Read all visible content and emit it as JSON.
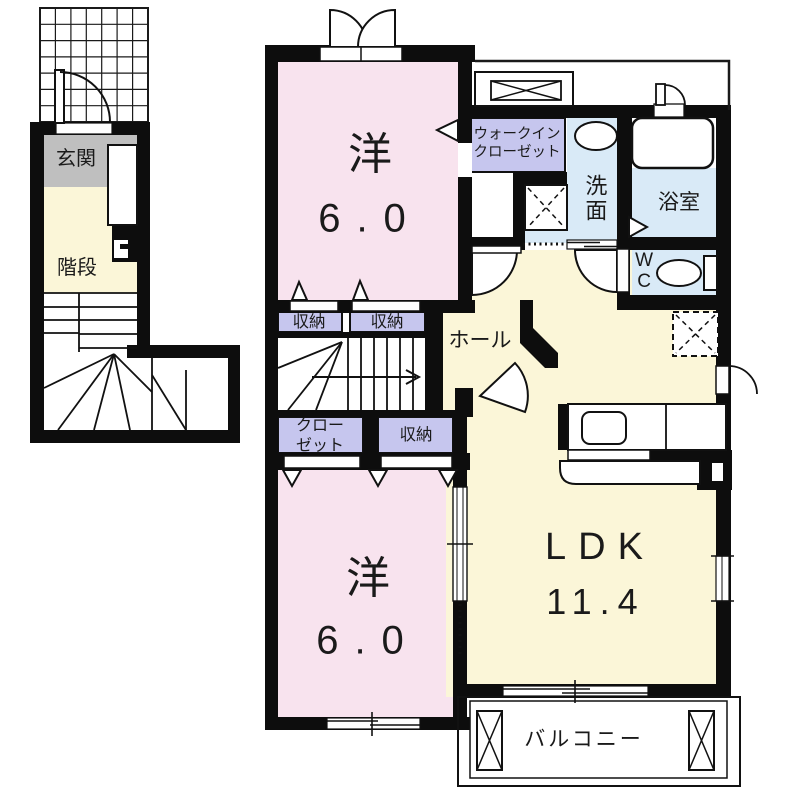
{
  "floorplan": {
    "entrance_label": "玄関",
    "stairs_label": "階段",
    "hall_label": "ホール",
    "bedroom_top": {
      "type": "洋",
      "size": "6.0"
    },
    "bedroom_bottom": {
      "type": "洋",
      "size": "6.0"
    },
    "ldk": {
      "type": "LDK",
      "size": "11.4"
    },
    "walk_in_closet_label": "ウォークイン\nクローゼット",
    "washroom_label": "洗面",
    "bathroom_label": "浴室",
    "toilet_label": "WC",
    "storage_label_1": "収納",
    "storage_label_2": "収納",
    "storage_label_3": "収納",
    "closet_label": "クロー\nゼット",
    "balcony_label": "バルコニー",
    "colors": {
      "bedroom": "#f8e3ee",
      "living": "#fbf6d8",
      "closet": "#c6c6ee",
      "wet_area": "#d9eaf7",
      "entrance": "#bfbfbf",
      "wall": "#0d0d0d"
    }
  }
}
